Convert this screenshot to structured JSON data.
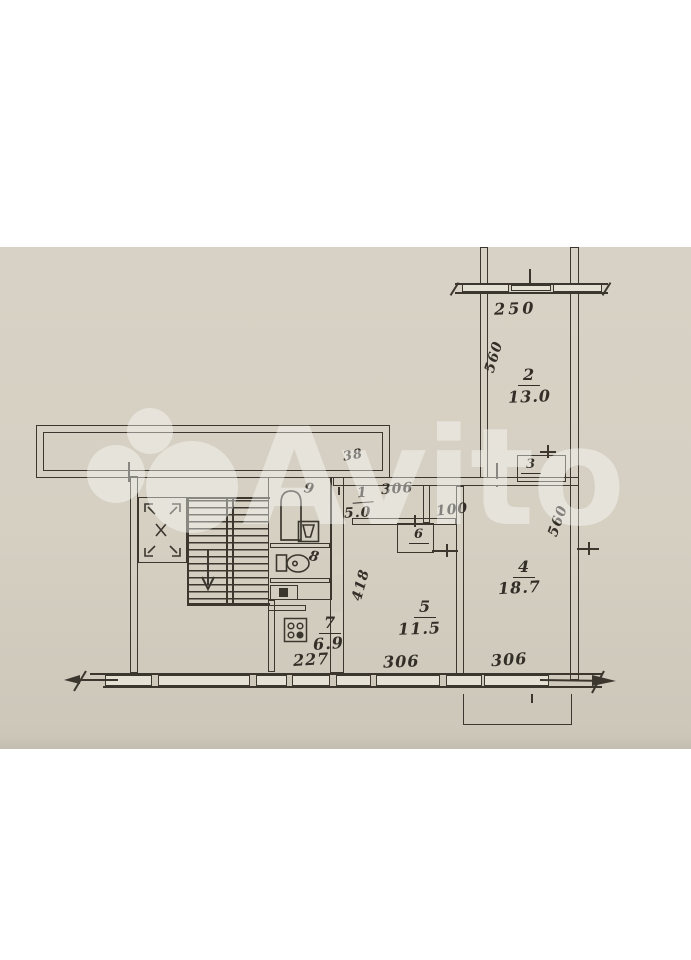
{
  "watermark": {
    "brand": "Avito"
  },
  "rooms": {
    "r1": {
      "num": "1",
      "area": "5.0"
    },
    "r2": {
      "num": "2",
      "area": "13.0"
    },
    "r3": {
      "num": "3"
    },
    "r4": {
      "num": "4",
      "area": "18.7"
    },
    "r5": {
      "num": "5",
      "area": "11.5"
    },
    "r6": {
      "num": "6"
    },
    "r7": {
      "num": "7",
      "area": "6.9"
    },
    "r8": {
      "num": "8"
    },
    "r9": {
      "num": "9"
    }
  },
  "dims": {
    "balcony_top": "250",
    "room2_depth": "560",
    "room4_depth": "560",
    "hall_width": "306",
    "niche_width": "100",
    "corridor_note": "38",
    "room5_depth": "418",
    "room5_width": "306",
    "room4_width": "306",
    "kitchen_width": "227"
  },
  "colors": {
    "paper": "#d6d0c3",
    "ink": "#3b372f"
  }
}
